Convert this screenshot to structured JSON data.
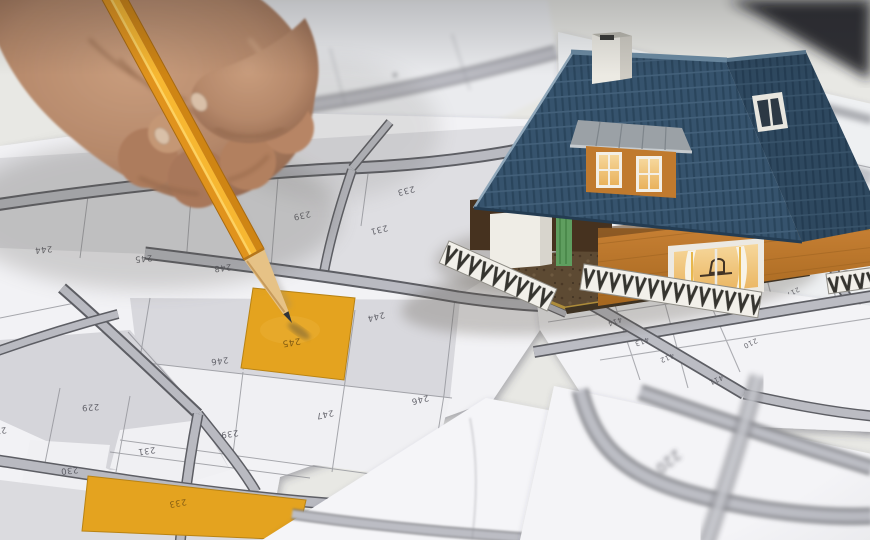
{
  "colors": {
    "highlight_parcel_orange": "#e4a31f",
    "pencil_body_orange": "#f7b731",
    "house_roof_blue": "#3b5a74",
    "house_wall_orange": "#c07a2e",
    "paper_white": "#f2f2f5",
    "road_fill_gray": "#b9bac1",
    "road_edge_gray": "#5d5e64",
    "background_wall_gray_green": "#9fa298"
  },
  "sheets": {
    "main": {
      "parcels": [
        {
          "label": "244"
        },
        {
          "label": "245"
        },
        {
          "label": "248"
        },
        {
          "label": "239"
        },
        {
          "label": "231"
        },
        {
          "label": "233"
        },
        {
          "label": "246"
        },
        {
          "label": "245",
          "highlight": true
        },
        {
          "label": "244"
        },
        {
          "label": "246"
        },
        {
          "label": "247"
        },
        {
          "label": "239"
        },
        {
          "label": "229"
        },
        {
          "label": "228"
        },
        {
          "label": "230"
        },
        {
          "label": "231"
        },
        {
          "label": "233",
          "highlight": true
        },
        {
          "label": "235"
        }
      ]
    },
    "right_upper": {
      "parcels": [
        {
          "label": "302",
          "highlight": true
        },
        {
          "label": "310"
        },
        {
          "label": "217"
        },
        {
          "label": "216"
        },
        {
          "label": "215"
        },
        {
          "label": "214"
        },
        {
          "label": "218"
        },
        {
          "label": "219"
        },
        {
          "label": "209"
        }
      ]
    },
    "right_lower": {
      "parcels": [
        {
          "label": "416"
        },
        {
          "label": "415"
        },
        {
          "label": "414"
        },
        {
          "label": "413"
        },
        {
          "label": "412"
        },
        {
          "label": "411"
        },
        {
          "label": "210"
        }
      ]
    },
    "bottom": {
      "parcels": [
        {
          "label": "220"
        }
      ]
    }
  }
}
